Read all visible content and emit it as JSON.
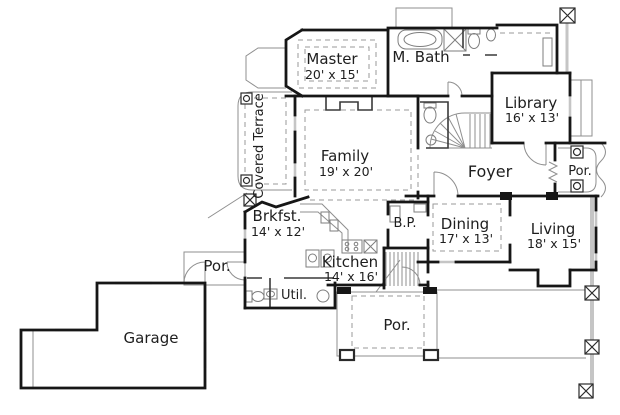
{
  "plan": {
    "rooms": {
      "master": {
        "name": "Master",
        "size": "20' x 15'"
      },
      "master_bath": {
        "name": "M. Bath"
      },
      "library": {
        "name": "Library",
        "size": "16' x 13'"
      },
      "covered_terrace": {
        "name": "Covered Terrace"
      },
      "family": {
        "name": "Family",
        "size": "19' x 20'"
      },
      "foyer": {
        "name": "Foyer"
      },
      "porch_right": {
        "name": "Por."
      },
      "breakfast": {
        "name": "Brkfst.",
        "size": "14' x 12'"
      },
      "butlers_pantry": {
        "name": "B.P."
      },
      "dining": {
        "name": "Dining",
        "size": "17' x 13'"
      },
      "living": {
        "name": "Living",
        "size": "18' x 15'"
      },
      "kitchen": {
        "name": "Kitchen",
        "size": "14' x 16'"
      },
      "utility": {
        "name": "Util."
      },
      "porch_left": {
        "name": "Por."
      },
      "garage": {
        "name": "Garage"
      },
      "porch_front": {
        "name": "Por."
      }
    },
    "colors": {
      "wall": "#161616",
      "thin_line": "#8f8f8f",
      "dashed_line": "#9a9a9a",
      "gray_band": "#c5c5c5",
      "text": "#1e1e1e",
      "background": "#ffffff"
    }
  }
}
